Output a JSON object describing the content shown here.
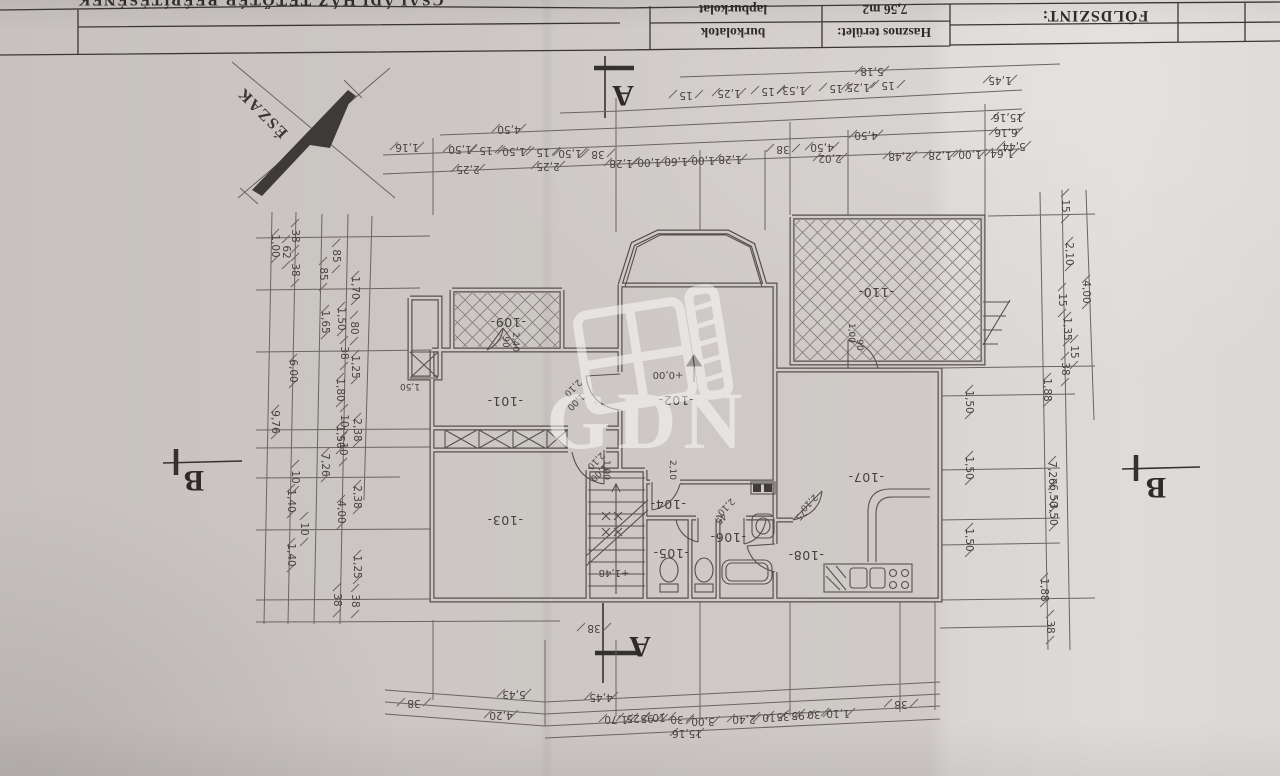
{
  "title_block": {
    "project_title": "CSALÁDI HÁZ TETŐTÉR BEÉPÍTÉSÉNEK",
    "sheet_label": "FÖLDSZINT:",
    "col1_header": "Hasznos terület:",
    "col2_header": "burkolatok",
    "area_value": "7,56 m2",
    "flooring_value": "lapburkolat"
  },
  "compass": {
    "label": "ÉSZAK"
  },
  "watermark": {
    "text": "GDN"
  },
  "section_markers": {
    "a": "A",
    "b": "B"
  },
  "colors": {
    "paper": "#cfcac7",
    "pencil": "#5d5854",
    "ink": "#3a3633",
    "watermark_white": "#ffffff"
  },
  "annotations": [
    {
      "t": "4,50",
      "x": 509,
      "y": 126
    },
    {
      "t": "1,16",
      "x": 407,
      "y": 144
    },
    {
      "t": "1,50",
      "x": 460,
      "y": 146
    },
    {
      "t": "15",
      "x": 486,
      "y": 147
    },
    {
      "t": "1,50",
      "x": 514,
      "y": 148
    },
    {
      "t": "15",
      "x": 543,
      "y": 149
    },
    {
      "t": "1,50",
      "x": 570,
      "y": 150
    },
    {
      "t": "38",
      "x": 598,
      "y": 151
    },
    {
      "t": "2,25",
      "x": 468,
      "y": 166
    },
    {
      "t": "2,25",
      "x": 548,
      "y": 163
    },
    {
      "t": "1,28",
      "x": 621,
      "y": 160
    },
    {
      "t": "1,00",
      "x": 649,
      "y": 159
    },
    {
      "t": "1,60",
      "x": 676,
      "y": 158
    },
    {
      "t": "1,00",
      "x": 703,
      "y": 157
    },
    {
      "t": "1,28",
      "x": 730,
      "y": 156
    },
    {
      "t": "2,02",
      "x": 830,
      "y": 155
    },
    {
      "t": "2,48",
      "x": 900,
      "y": 153
    },
    {
      "t": "1,28",
      "x": 940,
      "y": 152
    },
    {
      "t": "1,00",
      "x": 970,
      "y": 151
    },
    {
      "t": "1,64",
      "x": 1002,
      "y": 150
    },
    {
      "t": "5,18",
      "x": 872,
      "y": 68
    },
    {
      "t": "15",
      "x": 686,
      "y": 92
    },
    {
      "t": "1,25",
      "x": 729,
      "y": 90
    },
    {
      "t": "15",
      "x": 768,
      "y": 88
    },
    {
      "t": "1,53",
      "x": 794,
      "y": 87
    },
    {
      "t": "15",
      "x": 836,
      "y": 85
    },
    {
      "t": "1,25",
      "x": 858,
      "y": 84
    },
    {
      "t": "15",
      "x": 888,
      "y": 82
    },
    {
      "t": "1,45",
      "x": 1000,
      "y": 77
    },
    {
      "t": "15,16",
      "x": 1008,
      "y": 114
    },
    {
      "t": "6,16",
      "x": 1006,
      "y": 129
    },
    {
      "t": "4,50",
      "x": 866,
      "y": 132
    },
    {
      "t": "38",
      "x": 783,
      "y": 146
    },
    {
      "t": "4,50",
      "x": 822,
      "y": 144
    },
    {
      "t": "5,44",
      "x": 1014,
      "y": 143
    },
    {
      "t": "1,00",
      "x": 272,
      "y": 246,
      "r": 90
    },
    {
      "t": "38",
      "x": 292,
      "y": 236,
      "r": 90
    },
    {
      "t": "62",
      "x": 283,
      "y": 252,
      "r": 90
    },
    {
      "t": "38",
      "x": 292,
      "y": 270,
      "r": 90
    },
    {
      "t": "85",
      "x": 333,
      "y": 256,
      "r": 90
    },
    {
      "t": "85",
      "x": 320,
      "y": 274,
      "r": 90
    },
    {
      "t": "1,70",
      "x": 352,
      "y": 288,
      "r": 90
    },
    {
      "t": "1,65",
      "x": 322,
      "y": 322,
      "r": 90
    },
    {
      "t": "1,50",
      "x": 338,
      "y": 319,
      "r": 90
    },
    {
      "t": "80",
      "x": 351,
      "y": 328,
      "r": 90
    },
    {
      "t": "38",
      "x": 341,
      "y": 353,
      "r": 90
    },
    {
      "t": "1,25",
      "x": 352,
      "y": 367,
      "r": 90
    },
    {
      "t": "6,00",
      "x": 290,
      "y": 371,
      "r": 90
    },
    {
      "t": "1,80",
      "x": 337,
      "y": 390,
      "r": 90
    },
    {
      "t": "9,76",
      "x": 272,
      "y": 422,
      "r": 90
    },
    {
      "t": "10",
      "x": 341,
      "y": 421,
      "r": 90
    },
    {
      "t": "2,38",
      "x": 354,
      "y": 430,
      "r": 90
    },
    {
      "t": "1,50",
      "x": 337,
      "y": 437,
      "r": 90
    },
    {
      "t": "10",
      "x": 340,
      "y": 449,
      "r": 90
    },
    {
      "t": "7,26",
      "x": 322,
      "y": 465,
      "r": 90
    },
    {
      "t": "10",
      "x": 292,
      "y": 477,
      "r": 90
    },
    {
      "t": "1,40",
      "x": 288,
      "y": 501,
      "r": 90
    },
    {
      "t": "2,38",
      "x": 354,
      "y": 497,
      "r": 90
    },
    {
      "t": "4,00",
      "x": 338,
      "y": 512,
      "r": 90
    },
    {
      "t": "10",
      "x": 301,
      "y": 529,
      "r": 90
    },
    {
      "t": "1,40",
      "x": 288,
      "y": 555,
      "r": 90
    },
    {
      "t": "1,25",
      "x": 354,
      "y": 567,
      "r": 90
    },
    {
      "t": "38",
      "x": 334,
      "y": 600,
      "r": 90
    },
    {
      "t": "38",
      "x": 352,
      "y": 601,
      "r": 90
    },
    {
      "t": "15",
      "x": 1062,
      "y": 206,
      "r": 90
    },
    {
      "t": "2,10",
      "x": 1066,
      "y": 254,
      "r": 90
    },
    {
      "t": "4,00",
      "x": 1083,
      "y": 292,
      "r": 90
    },
    {
      "t": "15",
      "x": 1059,
      "y": 300,
      "r": 90
    },
    {
      "t": "1,35",
      "x": 1064,
      "y": 329,
      "r": 90
    },
    {
      "t": "15",
      "x": 1071,
      "y": 352,
      "r": 90
    },
    {
      "t": "38",
      "x": 1062,
      "y": 369,
      "r": 90
    },
    {
      "t": "1,88",
      "x": 1044,
      "y": 390,
      "r": 90
    },
    {
      "t": "1,50",
      "x": 966,
      "y": 402,
      "r": 90
    },
    {
      "t": "1,50",
      "x": 966,
      "y": 468,
      "r": 90
    },
    {
      "t": "1,50",
      "x": 966,
      "y": 540,
      "r": 90
    },
    {
      "t": "7,26",
      "x": 1049,
      "y": 473,
      "r": 90
    },
    {
      "t": "6,50",
      "x": 1050,
      "y": 496,
      "r": 90
    },
    {
      "t": "3,50",
      "x": 1050,
      "y": 514,
      "r": 90
    },
    {
      "t": "1,88",
      "x": 1041,
      "y": 590,
      "r": 90
    },
    {
      "t": "38",
      "x": 1047,
      "y": 627,
      "r": 90
    },
    {
      "t": "5,43",
      "x": 514,
      "y": 691
    },
    {
      "t": "4,45",
      "x": 601,
      "y": 694
    },
    {
      "t": "38",
      "x": 414,
      "y": 700
    },
    {
      "t": "4,20",
      "x": 501,
      "y": 712
    },
    {
      "t": "1,70",
      "x": 616,
      "y": 716
    },
    {
      "t": "25",
      "x": 633,
      "y": 715
    },
    {
      "t": "95",
      "x": 647,
      "y": 715
    },
    {
      "t": "10",
      "x": 659,
      "y": 714
    },
    {
      "t": "30",
      "x": 677,
      "y": 716
    },
    {
      "t": "3,00",
      "x": 703,
      "y": 718
    },
    {
      "t": "2,40",
      "x": 744,
      "y": 716
    },
    {
      "t": "10",
      "x": 769,
      "y": 714
    },
    {
      "t": "35",
      "x": 783,
      "y": 713
    },
    {
      "t": "95",
      "x": 798,
      "y": 712
    },
    {
      "t": "30",
      "x": 814,
      "y": 711
    },
    {
      "t": "1,10",
      "x": 838,
      "y": 710
    },
    {
      "t": "38",
      "x": 901,
      "y": 701
    },
    {
      "t": "15,16",
      "x": 687,
      "y": 730
    },
    {
      "t": "38",
      "x": 594,
      "y": 625
    },
    {
      "t": "-101-",
      "x": 505,
      "y": 397,
      "c": "room"
    },
    {
      "t": "-102-",
      "x": 676,
      "y": 396,
      "c": "room"
    },
    {
      "t": "-103-",
      "x": 505,
      "y": 516,
      "c": "room"
    },
    {
      "t": "-104-",
      "x": 668,
      "y": 500,
      "c": "room"
    },
    {
      "t": "-105-",
      "x": 671,
      "y": 549,
      "c": "room"
    },
    {
      "t": "-106-",
      "x": 728,
      "y": 533,
      "c": "room"
    },
    {
      "t": "-107-",
      "x": 866,
      "y": 473,
      "c": "room"
    },
    {
      "t": "-108-",
      "x": 806,
      "y": 551,
      "c": "room"
    },
    {
      "t": "-109-",
      "x": 508,
      "y": 318,
      "c": "room"
    },
    {
      "t": "-110-",
      "x": 876,
      "y": 288,
      "c": "room"
    },
    {
      "t": "+0,00",
      "x": 668,
      "y": 372,
      "c": "lvl"
    },
    {
      "t": "+1,48",
      "x": 614,
      "y": 570,
      "c": "lvl"
    },
    {
      "t": "1,50",
      "x": 410,
      "y": 384,
      "c": "door"
    },
    {
      "t": "2,10",
      "x": 571,
      "y": 386,
      "r": 135,
      "c": "door"
    },
    {
      "t": "1,00",
      "x": 574,
      "y": 400,
      "r": 135,
      "c": "door"
    },
    {
      "t": "2,10",
      "x": 594,
      "y": 459,
      "r": 135,
      "c": "door"
    },
    {
      "t": "1,00",
      "x": 597,
      "y": 471,
      "r": 135,
      "c": "door"
    },
    {
      "t": "2,10",
      "x": 724,
      "y": 505,
      "r": 135,
      "c": "door"
    },
    {
      "t": "45",
      "x": 719,
      "y": 517,
      "r": 135,
      "c": "door"
    },
    {
      "t": "75",
      "x": 799,
      "y": 513,
      "r": 135,
      "c": "door"
    },
    {
      "t": "2,10",
      "x": 807,
      "y": 501,
      "r": 135,
      "c": "door"
    },
    {
      "t": "90",
      "x": 503,
      "y": 342,
      "r": 90,
      "c": "door"
    },
    {
      "t": "2,40",
      "x": 513,
      "y": 342,
      "r": 90,
      "c": "door"
    },
    {
      "t": "1,00",
      "x": 849,
      "y": 333,
      "r": 90,
      "c": "door"
    },
    {
      "t": "90",
      "x": 857,
      "y": 345,
      "r": 90,
      "c": "door"
    },
    {
      "t": "2,10",
      "x": 670,
      "y": 470,
      "r": 90,
      "c": "door"
    },
    {
      "t": "1,00",
      "x": 604,
      "y": 470,
      "r": 90,
      "c": "door"
    }
  ]
}
